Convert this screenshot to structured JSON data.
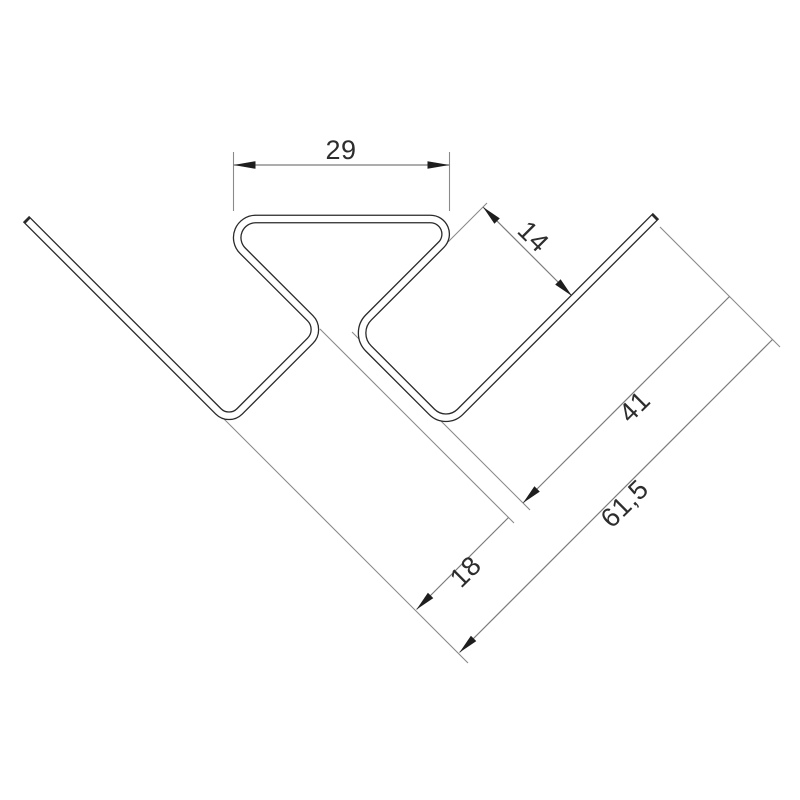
{
  "drawing": {
    "title": "corner-profile-cross-section",
    "kind": "technical-dimension-drawing",
    "background_color": "#ffffff",
    "profile_line_color": "#2a2a2a",
    "dimension_line_color": "#7c7c7c",
    "arrow_color": "#1e1e1e",
    "text_color": "#2d2d2d",
    "dimensions": [
      {
        "id": "top-width",
        "label": "29"
      },
      {
        "id": "right-channel-width",
        "label": "14"
      },
      {
        "id": "right-leg-length",
        "label": "41"
      },
      {
        "id": "overall-length",
        "label": "61,5"
      },
      {
        "id": "left-channel-width",
        "label": "18"
      }
    ]
  }
}
